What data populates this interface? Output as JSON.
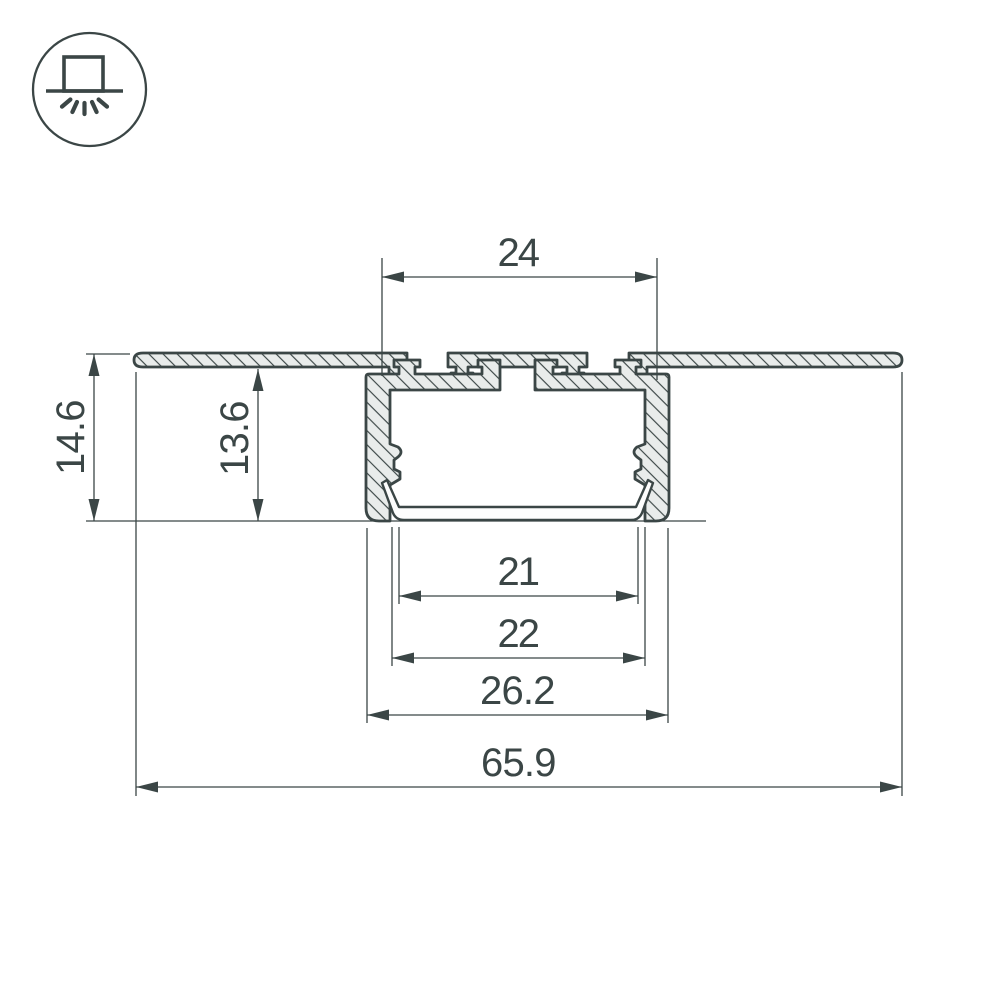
{
  "page": {
    "background": "#ffffff",
    "title": "recessed-led-profile-cross-section"
  },
  "icon": {
    "name": "recessed-mount-light-icon",
    "meaning": "recessed ceiling mounting with downlight"
  },
  "drawing": {
    "type": "profile-cross-section",
    "dimensions": {
      "top_width": "24",
      "overall_height": "14.6",
      "recess_depth": "13.6",
      "tray_width": "21",
      "inner_width": "22",
      "body_width": "26.2",
      "overall_width": "65.9"
    },
    "colors": {
      "line": "#3b4646",
      "material_fill": "#e9eceb",
      "background": "#ffffff"
    }
  }
}
